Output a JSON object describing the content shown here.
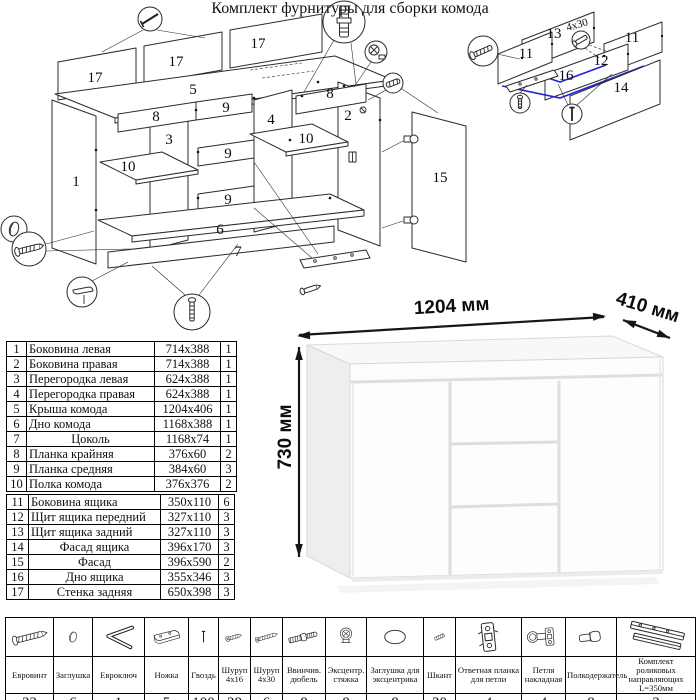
{
  "assembly": {
    "labels": {
      "back1": "17",
      "back2": "17",
      "back3": "17",
      "top": "5",
      "side_left": "1",
      "side_right": "2",
      "partition_left": "3",
      "partition_right": "4",
      "rail8_left": "8",
      "rail8_right": "8",
      "rail9_top": "9",
      "rail9_mid": "9",
      "rail9_bottom": "9",
      "shelf_left": "10",
      "shelf_right": "10",
      "bottom": "6",
      "plinth": "7",
      "door": "15"
    }
  },
  "drawer_detail": {
    "labels": {
      "back": "13",
      "side_left": "11",
      "side_right": "11",
      "front_inner": "12",
      "facade": "14",
      "bottom": "16"
    },
    "screw_note": "4x30",
    "highlight_color": "#2222dd"
  },
  "dresser": {
    "width_label": "1204 мм",
    "depth_label": "410 мм",
    "height_label": "730 мм"
  },
  "parts": {
    "rows": [
      {
        "n": "1",
        "name": "Боковина левая",
        "size": "714x388",
        "qty": "1"
      },
      {
        "n": "2",
        "name": "Боковина правая",
        "size": "714x388",
        "qty": "1"
      },
      {
        "n": "3",
        "name": "Перегородка левая",
        "size": "624x388",
        "qty": "1"
      },
      {
        "n": "4",
        "name": "Перегородка правая",
        "size": "624x388",
        "qty": "1"
      },
      {
        "n": "5",
        "name": "Крыша комода",
        "size": "1204x406",
        "qty": "1"
      },
      {
        "n": "6",
        "name": "Дно комода",
        "size": "1168x388",
        "qty": "1"
      },
      {
        "n": "7",
        "name": "Цоколь",
        "size": "1168x74",
        "qty": "1"
      },
      {
        "n": "8",
        "name": "Планка крайняя",
        "size": "376x60",
        "qty": "2"
      },
      {
        "n": "9",
        "name": "Планка средняя",
        "size": "384x60",
        "qty": "3"
      },
      {
        "n": "10",
        "name": "Полка комода",
        "size": "376x376",
        "qty": "2"
      },
      {
        "n": "11",
        "name": "Боковина ящика",
        "size": "350x110",
        "qty": "6"
      },
      {
        "n": "12",
        "name": "Щит ящика передний",
        "size": "327x110",
        "qty": "3"
      },
      {
        "n": "13",
        "name": "Щит ящика задний",
        "size": "327x110",
        "qty": "3"
      },
      {
        "n": "14",
        "name": "Фасад ящика",
        "size": "396x170",
        "qty": "3"
      },
      {
        "n": "15",
        "name": "Фасад",
        "size": "396x590",
        "qty": "2"
      },
      {
        "n": "16",
        "name": "Дно ящика",
        "size": "355x346",
        "qty": "3"
      },
      {
        "n": "17",
        "name": "Стенка задняя",
        "size": "650x398",
        "qty": "3"
      }
    ]
  },
  "hardware": {
    "title": "Комплект фурнитуры для сборки комода",
    "items": [
      {
        "name": "Евровинт",
        "qty": "22"
      },
      {
        "name": "Заглушка",
        "qty": "6"
      },
      {
        "name": "Евроключ",
        "qty": "1"
      },
      {
        "name": "Ножка",
        "qty": "5"
      },
      {
        "name": "Гвоздь",
        "qty": "100"
      },
      {
        "name": "Шуруп 4x16",
        "qty": "28"
      },
      {
        "name": "Шуруп 4x30",
        "qty": "6"
      },
      {
        "name": "Ввинчив. дюбель",
        "qty": "8"
      },
      {
        "name": "Эксцентр. стяжка",
        "qty": "8"
      },
      {
        "name": "Заглушка для эксцентрика",
        "qty": "8"
      },
      {
        "name": "Шкант",
        "qty": "20"
      },
      {
        "name": "Ответная планка для петли",
        "qty": "4"
      },
      {
        "name": "Петля накладная",
        "qty": "4"
      },
      {
        "name": "Полкодержатель",
        "qty": "8"
      },
      {
        "name": "Комплект роликовых направляющих L=350мм",
        "qty": "3"
      }
    ]
  }
}
